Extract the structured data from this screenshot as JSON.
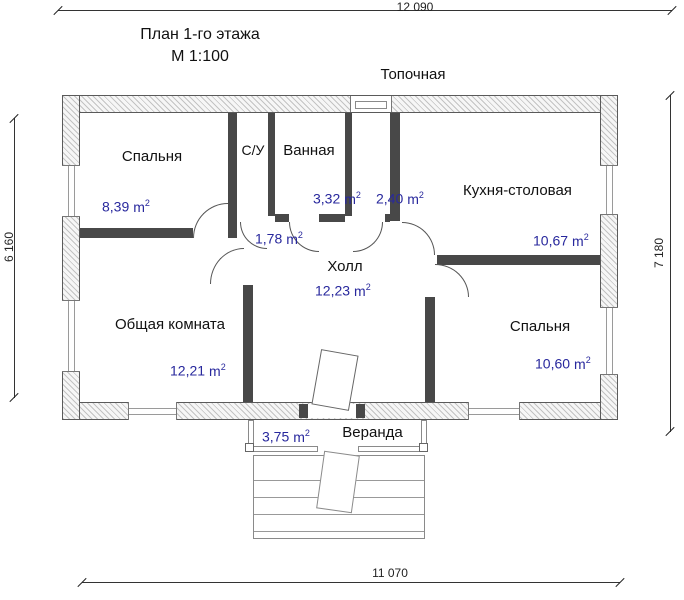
{
  "title": {
    "line1": "План 1-го этажа",
    "line2": "М 1:100"
  },
  "dimensions": {
    "top": "12 090",
    "left": "6 160",
    "right": "7 180",
    "bottom": "11 070"
  },
  "unit": {
    "symbol": "m",
    "sup": "2"
  },
  "colors": {
    "area_text": "#28289d",
    "interior_wall": "#484848",
    "dim_text": "#222222"
  },
  "rooms": [
    {
      "name": "Спальня",
      "area": "8,39"
    },
    {
      "name": "С/У",
      "area": "1,78"
    },
    {
      "name": "Ванная",
      "area": "3,32"
    },
    {
      "name": "Топочная",
      "area": "2,40"
    },
    {
      "name": "Кухня-столовая",
      "area": "10,67"
    },
    {
      "name": "Холл",
      "area": "12,23"
    },
    {
      "name": "Общая комната",
      "area": "12,21"
    },
    {
      "name": "Спальня",
      "area": "10,60"
    },
    {
      "name": "Веранда",
      "area": "3,75"
    }
  ]
}
